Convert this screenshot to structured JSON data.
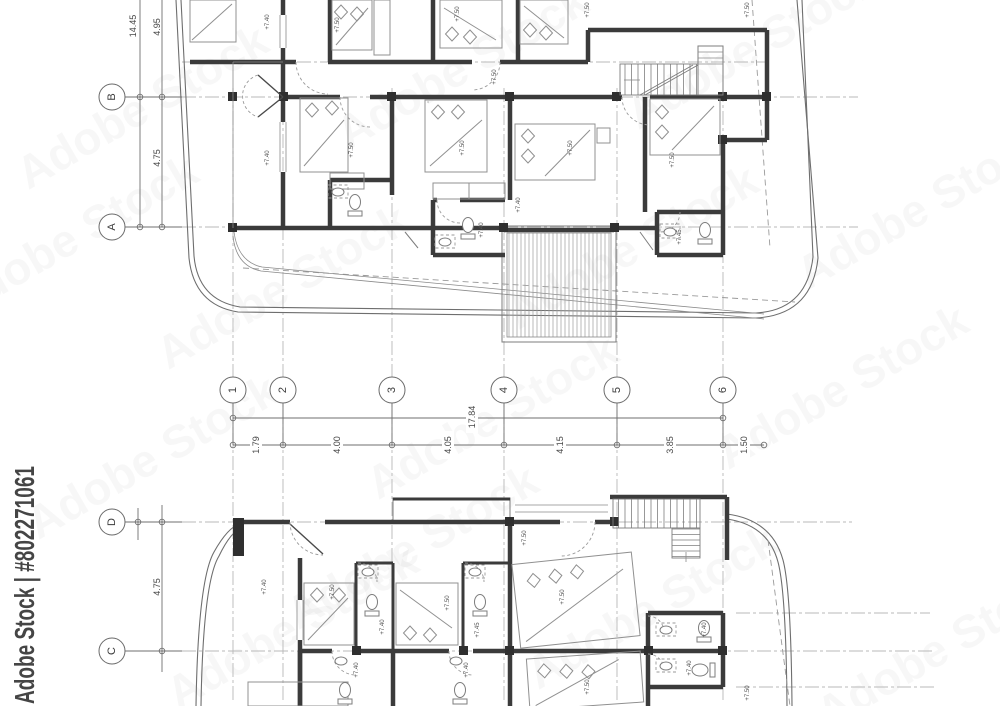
{
  "watermark": {
    "side": "Adobe Stock | #802271061",
    "ghost": "Adobe Stock"
  },
  "column_grid": {
    "bubble_y": 390,
    "bubble_r": 13,
    "bubbles": [
      {
        "label": "1",
        "x": 233
      },
      {
        "label": "2",
        "x": 283
      },
      {
        "label": "3",
        "x": 392
      },
      {
        "label": "4",
        "x": 504
      },
      {
        "label": "5",
        "x": 617
      },
      {
        "label": "6",
        "x": 723
      }
    ],
    "overall": {
      "label": "17.84",
      "x": 472,
      "y": 417
    },
    "segments": [
      {
        "label": "1.79",
        "x": 256
      },
      {
        "label": "4.00",
        "x": 337
      },
      {
        "label": "4.05",
        "x": 448
      },
      {
        "label": "4.15",
        "x": 560
      },
      {
        "label": "3.85",
        "x": 670
      },
      {
        "label": "1.50",
        "x": 744
      }
    ],
    "segment_line_y": 445
  },
  "row_grid_upper": {
    "bubble_x": 112,
    "bubble_r": 13,
    "bubbles": [
      {
        "label": "B",
        "y": 97
      },
      {
        "label": "A",
        "y": 227
      }
    ],
    "dims": [
      {
        "label": "14.45",
        "x": 133,
        "y": 26
      },
      {
        "label": "4.95",
        "x": 157,
        "y": 27
      },
      {
        "label": "4.75",
        "x": 157,
        "y": 158
      }
    ]
  },
  "row_grid_lower": {
    "bubble_x": 112,
    "bubble_r": 13,
    "bubbles": [
      {
        "label": "D",
        "y": 522
      },
      {
        "label": "C",
        "y": 651
      }
    ],
    "dims": [
      {
        "label": "4.75",
        "x": 157,
        "y": 587
      }
    ]
  },
  "level_labels": [
    {
      "t": "+7.40",
      "x": 268,
      "y": 22
    },
    {
      "t": "+7.50",
      "x": 338,
      "y": 25
    },
    {
      "t": "+7.50",
      "x": 458,
      "y": 14
    },
    {
      "t": "+7.50",
      "x": 588,
      "y": 10
    },
    {
      "t": "+7.50",
      "x": 748,
      "y": 10
    },
    {
      "t": "+7.50",
      "x": 495,
      "y": 77
    },
    {
      "t": "+7.40",
      "x": 268,
      "y": 158
    },
    {
      "t": "+7.50",
      "x": 352,
      "y": 150
    },
    {
      "t": "+7.50",
      "x": 463,
      "y": 148
    },
    {
      "t": "+7.50",
      "x": 571,
      "y": 148
    },
    {
      "t": "+7.50",
      "x": 673,
      "y": 160
    },
    {
      "t": "+7.40",
      "x": 519,
      "y": 205
    },
    {
      "t": "+7.40",
      "x": 482,
      "y": 230
    },
    {
      "t": "+7.45",
      "x": 680,
      "y": 237
    },
    {
      "t": "+7.40",
      "x": 265,
      "y": 587
    },
    {
      "t": "+7.50",
      "x": 333,
      "y": 592
    },
    {
      "t": "+7.50",
      "x": 448,
      "y": 603
    },
    {
      "t": "+7.50",
      "x": 525,
      "y": 538
    },
    {
      "t": "+7.50",
      "x": 563,
      "y": 597
    },
    {
      "t": "+7.40",
      "x": 383,
      "y": 627
    },
    {
      "t": "+7.45",
      "x": 478,
      "y": 630
    },
    {
      "t": "+7.40",
      "x": 705,
      "y": 630
    },
    {
      "t": "+7.40",
      "x": 690,
      "y": 668
    },
    {
      "t": "+7.40",
      "x": 357,
      "y": 670
    },
    {
      "t": "+7.40",
      "x": 467,
      "y": 670
    },
    {
      "t": "+7.50",
      "x": 588,
      "y": 687
    },
    {
      "t": "+7.50",
      "x": 748,
      "y": 693
    }
  ]
}
